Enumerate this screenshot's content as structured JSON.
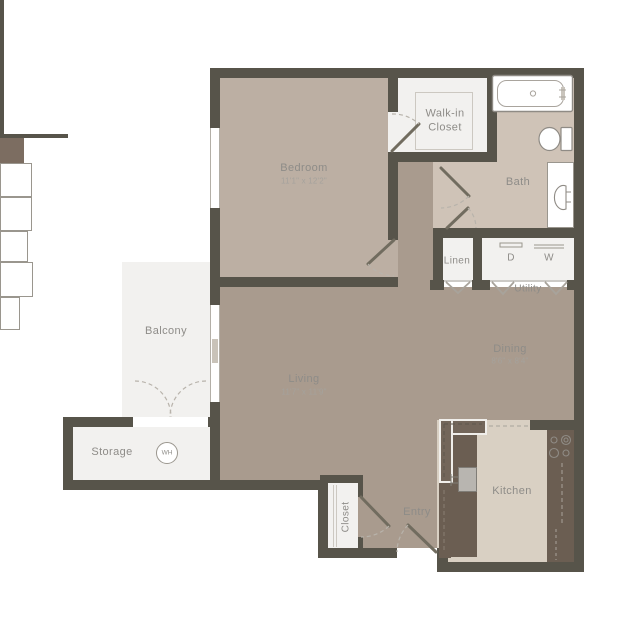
{
  "plan": {
    "rooms": {
      "bedroom": {
        "label": "Bedroom",
        "dims": "11'1\" x 12'2\""
      },
      "walk_in_closet": {
        "label": "Walk-in Closet"
      },
      "bath": {
        "label": "Bath"
      },
      "linen": {
        "label": "Linen"
      },
      "utility": {
        "label": "Utility"
      },
      "dining": {
        "label": "Dining",
        "dims": "8'6\" x 8'4\""
      },
      "living": {
        "label": "Living",
        "dims": "11'7\" x 11'9\""
      },
      "balcony": {
        "label": "Balcony"
      },
      "storage": {
        "label": "Storage"
      },
      "entry_closet": {
        "label": "Closet"
      },
      "entry": {
        "label": "Entry"
      },
      "kitchen": {
        "label": "Kitchen"
      }
    },
    "appliances": {
      "dryer": "D",
      "washer": "W",
      "water_heater": "WH"
    },
    "colors": {
      "wall": "#57544A",
      "bedroom_floor": "#BCAFA3",
      "living_floor": "#A99B8E",
      "bath_floor": "#CFC3B7",
      "kitchen_floor": "#D9D0C3",
      "light_floor": "#F2F1EF",
      "counter": "#6B5E52",
      "column": "#7C6D61",
      "label_text": "#8E8C88"
    }
  }
}
